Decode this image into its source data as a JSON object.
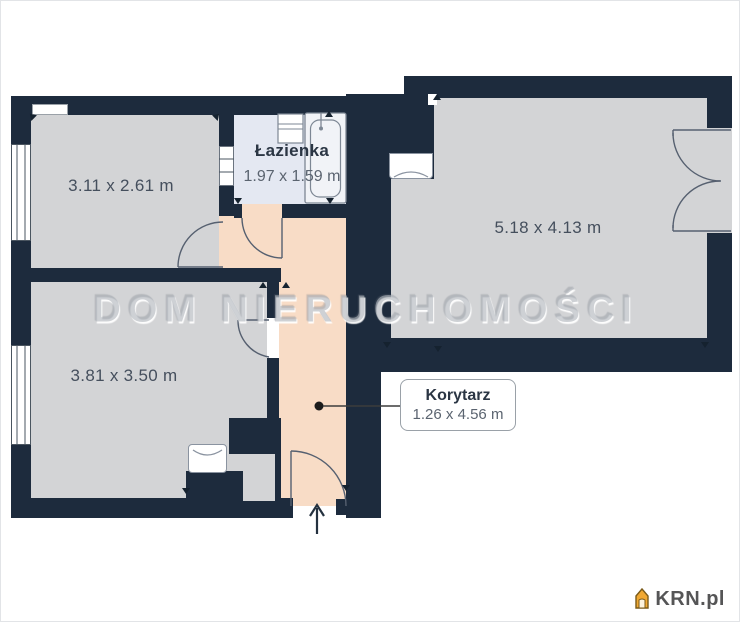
{
  "plan": {
    "watermark": "DOM NIERUCHOMOŚCI",
    "rooms": [
      {
        "id": "room-top-left",
        "dimensions": "3.11 x 2.61 m"
      },
      {
        "id": "room-bottom-left",
        "dimensions": "3.81 x 3.50 m"
      },
      {
        "id": "room-large",
        "dimensions": "5.18 x 4.13 m"
      },
      {
        "id": "bathroom",
        "name": "Łazienka",
        "dimensions": "1.97 x 1.59 m"
      },
      {
        "id": "corridor",
        "name": "Korytarz",
        "dimensions": "1.26 x 4.56 m"
      }
    ],
    "colors": {
      "wall": "#1d2b3d",
      "room_floor": "#d3d4d6",
      "bathroom_floor": "#e4e8f2",
      "corridor_floor": "#f8dcc6",
      "logo_accent": "#f0a832"
    },
    "logo": {
      "text": "KRN.pl"
    }
  }
}
